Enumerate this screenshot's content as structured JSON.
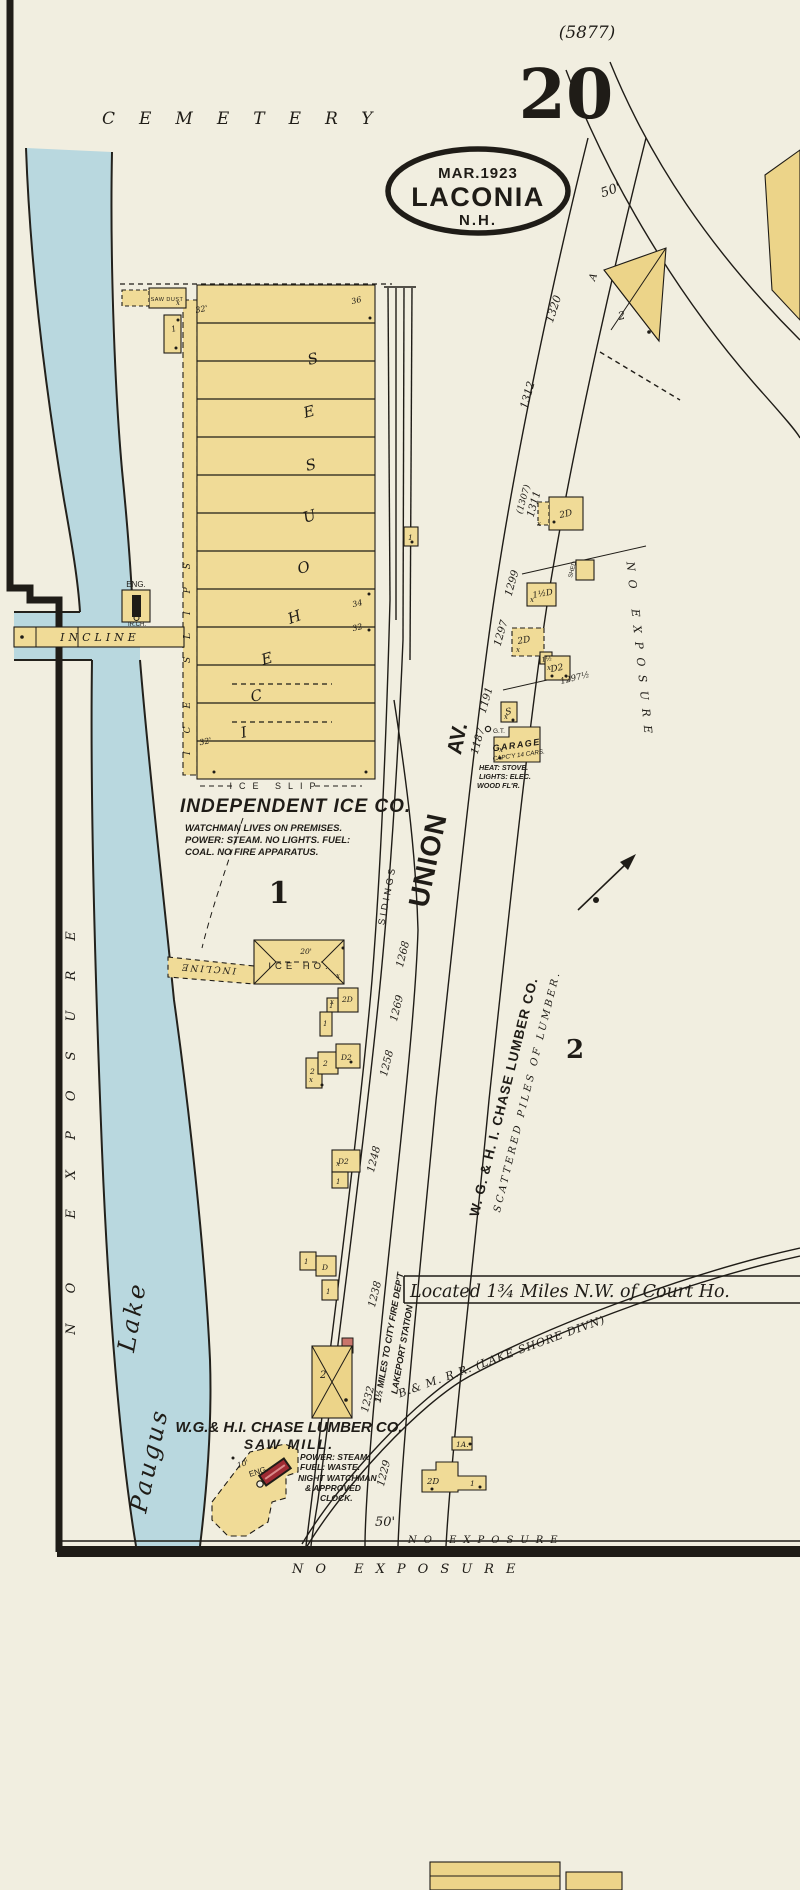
{
  "colors": {
    "paper": "#f1eee0",
    "water": "#b9d8df",
    "building_yellow": "#f0db97",
    "ink": "#1f1c17",
    "boiler_red": "#9e2b33"
  },
  "sheet": {
    "plate_ref": "(5877)",
    "number": "20",
    "stamp_date": "MAR.1923",
    "stamp_city": "LACONIA",
    "stamp_state": "N.H."
  },
  "areas": {
    "cemetery": "CEMETERY",
    "lake_word1": "Lake",
    "lake_word2": "Paugus",
    "no_exposure": "NO EXPOSURE",
    "district_1": "1",
    "district_2": "2"
  },
  "streets": {
    "union": "UNION",
    "union_av": "AV.",
    "sidings": "SIDINGS",
    "railroad": "B.& M. R.R. (LAKE SHORE DIVN)",
    "located_note": "Located 1¾ Miles N.W. of Court Ho.",
    "fire_note": "1½ MILES TO CITY FIRE DEP'T",
    "station_note": "LAKEPORT STATION",
    "dim_50_top": "50'",
    "dim_50_bottom": "50'",
    "letter_a": "A"
  },
  "numbers": {
    "n1320": "1320",
    "n1312": "1312",
    "n1307": "(1307)",
    "n1311": "1311",
    "n1299": "1299",
    "n1297": "1297",
    "n1297h": "1297½",
    "n1191": "1191",
    "n1187": "1187",
    "n1268": "1268",
    "n1269": "1269",
    "n1258": "1258",
    "n1248": "1248",
    "n1238": "1238",
    "n1232": "1232",
    "n1229": "1229"
  },
  "ice_co": {
    "name": "INDEPENDENT ICE CO.",
    "note1": "WATCHMAN LIVES ON PREMISES.",
    "note2": "POWER: STEAM. NO LIGHTS. FUEL:",
    "note3": "COAL. NO FIRE APPARATUS.",
    "houses_label": "ICE HOUSES",
    "slips_label": "ICE SLIPS",
    "slip_label": "ICE SLIP",
    "saw_dust": "SAW DUST",
    "eng": "ENG.",
    "iron_chimney": "IR.CH.",
    "incline": "INCLINE",
    "ice_house_small": "ICE HO.",
    "dim_20": "20'",
    "dim_36": "36",
    "dim_34": "34",
    "dim_32a": "32",
    "dim_32b": "32'",
    "dim_32c": "32'"
  },
  "lumber": {
    "company": "W. G. & H. I. CHASE LUMBER CO.",
    "scattered": "SCATTERED PILES OF LUMBER.",
    "sawmill_name": "W.G.& H.I. CHASE LUMBER CO.",
    "sawmill_sub": "SAW MILL.",
    "note1": "POWER: STEAM.",
    "note2": "FUEL: WASTE.",
    "note3": "NIGHT WATCHMAN",
    "note4": "& APPROVED",
    "note5": "CLOCK.",
    "eng_dim": "10'",
    "eng": "ENG.",
    "mill_label": "2"
  },
  "garage": {
    "name": "GARAGE",
    "capacity": "CAPC'Y 14 CARS.",
    "heat": "HEAT: STOVE.",
    "lights": "LIGHTS: ELEC.",
    "floor": "WOOD FL'R.",
    "gas_tank": "G.T."
  },
  "buildings": {
    "shed": "SHED",
    "b1311": "2D",
    "b1299": "1½D",
    "b1297": "2D",
    "b1297c": "1½",
    "b1297b": "D2",
    "stable": "S",
    "b1a": "1A.",
    "b1229": "2D",
    "b1229w": "1",
    "triangle": "2",
    "cl_a1": "2D",
    "cl_a2": "1",
    "cl_a3": "1",
    "cl_b1": "2",
    "cl_b2": "2",
    "cl_b3": "D2",
    "cl_c1": "D2",
    "cl_c2": "1",
    "cl_d1": "1",
    "cl_d2": "D",
    "cl_d3": "1",
    "b_rr": "1",
    "b_top": "1"
  },
  "marks": {
    "x": "x"
  }
}
